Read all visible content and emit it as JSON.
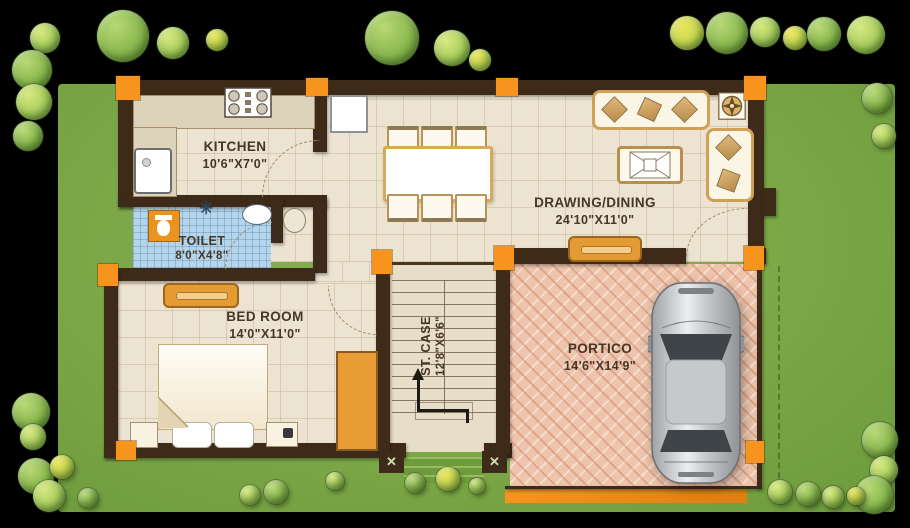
{
  "plan": {
    "rooms": {
      "kitchen": {
        "label": "KITCHEN",
        "dims": "10'6\"X7'0\""
      },
      "toilet": {
        "label": "TOILET",
        "dims": "8'0\"X4'8\""
      },
      "drawing_dining": {
        "label": "DRAWING/DINING",
        "dims": "24'10\"X11'0\""
      },
      "bedroom": {
        "label": "BED ROOM",
        "dims": "14'0\"X11'0\""
      },
      "staircase": {
        "label": "ST. CASE",
        "dims": "12'8\"X6'6\""
      },
      "portico": {
        "label": "PORTICO",
        "dims": "14'6\"X14'9\""
      }
    },
    "markers": {
      "column_x": "✕",
      "shower": "✳"
    },
    "colors": {
      "background": "#000000",
      "lawn": "#7ca746",
      "wall": "#3e2a18",
      "column_accent": "#f7941d",
      "floor": "#ece3d1",
      "toilet_floor": "#b5d6ea",
      "portico_floor": "#edc4ac"
    }
  }
}
